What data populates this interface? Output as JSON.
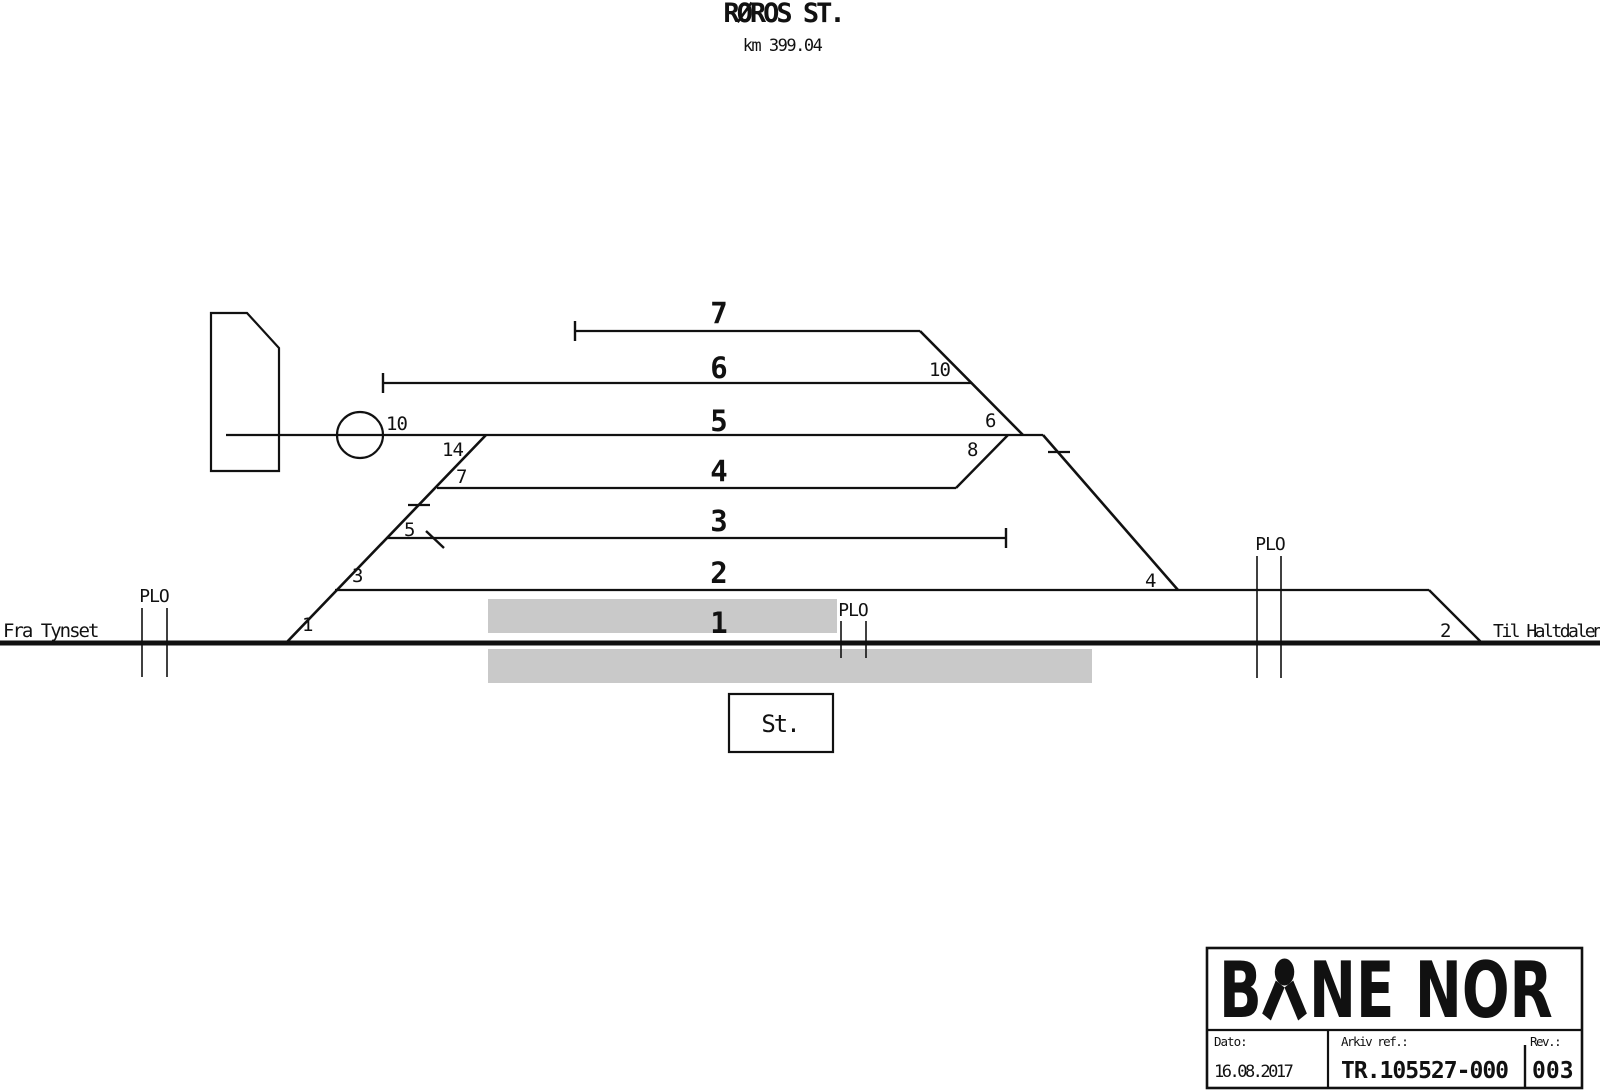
{
  "title": {
    "station": "RØROS ST.",
    "km": "km 399.04"
  },
  "endpoints": {
    "left": "Fra Tynset",
    "right": "Til Haltdalen"
  },
  "plo_label": "PLO",
  "tracks": {
    "t7": "7",
    "t6": "6",
    "t5": "5",
    "t4": "4",
    "t3": "3",
    "t2": "2",
    "t1": "1"
  },
  "switches": {
    "sw1": "1",
    "sw3": "3",
    "sw5": "5",
    "sw7": "7",
    "sw14": "14",
    "turntable": "10",
    "sw10": "10",
    "sw6": "6",
    "sw8": "8",
    "sw4": "4",
    "sw2": "2"
  },
  "station_box": {
    "label": "St."
  },
  "title_block": {
    "logo_b": "B",
    "logo_ne": "NE",
    "logo_nor": "NOR",
    "dato_label": "Dato:",
    "dato_value": "16.08.2017",
    "arkiv_label": "Arkiv ref.:",
    "arkiv_value": "TR.105527-000",
    "rev_label": "Rev.:",
    "rev_value": "003"
  },
  "colors": {
    "line": "#111111",
    "platform": "#c9c9c9",
    "background": "#ffffff"
  }
}
